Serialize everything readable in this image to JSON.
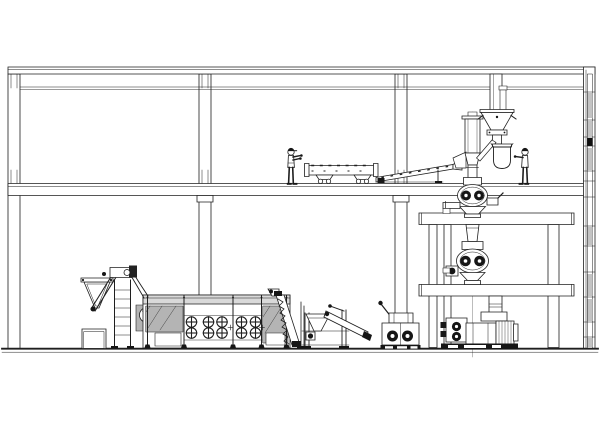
{
  "document": {
    "kind": "cad-line-drawing",
    "view": "side-elevation",
    "subject": "two-storey plant building with feed/food processing production line",
    "visible_text": "none"
  },
  "palette": {
    "ink": "#1f1f1f",
    "paper": "#ffffff",
    "hatch": "#b4b4b4",
    "band": "#d9d9d9",
    "dark": "#161616",
    "wall_panel": "#c3c3c3",
    "wall_panel_dark": "#101010"
  },
  "building": {
    "storeys": 2,
    "interior_columns": 3,
    "right_wall_ticks_y": [
      92,
      120,
      137,
      146,
      171,
      181,
      197,
      226,
      246,
      272,
      297,
      322,
      337
    ],
    "right_wall_panels": [
      {
        "y": 93,
        "h": 25,
        "tone": "g"
      },
      {
        "y": 121,
        "h": 15,
        "tone": "g"
      },
      {
        "y": 138,
        "h": 8,
        "tone": "b"
      },
      {
        "y": 148,
        "h": 22,
        "tone": "g"
      },
      {
        "y": 227,
        "h": 18,
        "tone": "g"
      },
      {
        "y": 274,
        "h": 22,
        "tone": "g"
      },
      {
        "y": 299,
        "h": 22,
        "tone": "g"
      },
      {
        "y": 338,
        "h": 9,
        "tone": "g"
      }
    ]
  },
  "dryer": {
    "fan_columns_x": [
      191.5,
      208.5,
      222,
      241.5,
      255.5
    ],
    "fan_rows_y": [
      322,
      333
    ],
    "fan_radius": 5.2,
    "cross_marks_x": [
      230.5,
      262
    ],
    "cross_marks_y": 327.5,
    "post_x": [
      147.5,
      184,
      233,
      261.5,
      286.5
    ]
  },
  "components": [
    {
      "id": "feed-hopper-elevator",
      "label": "wet-mix feed hopper with inclined elevator"
    },
    {
      "id": "crate",
      "label": "crate / pallet box"
    },
    {
      "id": "belt-dryer",
      "label": "multi-zone belt dryer with circulation fans"
    },
    {
      "id": "discharge-elevator",
      "label": "dryer discharge spiral elevator"
    },
    {
      "id": "vibrating-screener",
      "label": "vibrating screener with discharge chute"
    },
    {
      "id": "coating-machine",
      "label": "twin-drum coating machine"
    },
    {
      "id": "support-platform",
      "label": "two-level steel support platform"
    },
    {
      "id": "grinder-upper",
      "label": "upper twin-roller grinder"
    },
    {
      "id": "grinder-lower",
      "label": "lower twin-roller grinder"
    },
    {
      "id": "extruder",
      "label": "floor extruder with drive motor"
    },
    {
      "id": "surge-bin",
      "label": "surge bin with cone feeder"
    },
    {
      "id": "sack-tip-hopper",
      "label": "sack-tip hopper with dust bag"
    },
    {
      "id": "roof-duct",
      "label": "vertical duct from roof"
    },
    {
      "id": "vibrating-conveyor",
      "label": "vibrating tube conveyor (upper floor)"
    },
    {
      "id": "inclined-conveyor",
      "label": "inclined belt conveyor (upper floor)"
    }
  ],
  "workers": [
    {
      "id": "operator-conveyor",
      "pose": "standing, arms extended right"
    },
    {
      "id": "operator-bag-station",
      "pose": "standing, arm extended left toward bag"
    }
  ]
}
